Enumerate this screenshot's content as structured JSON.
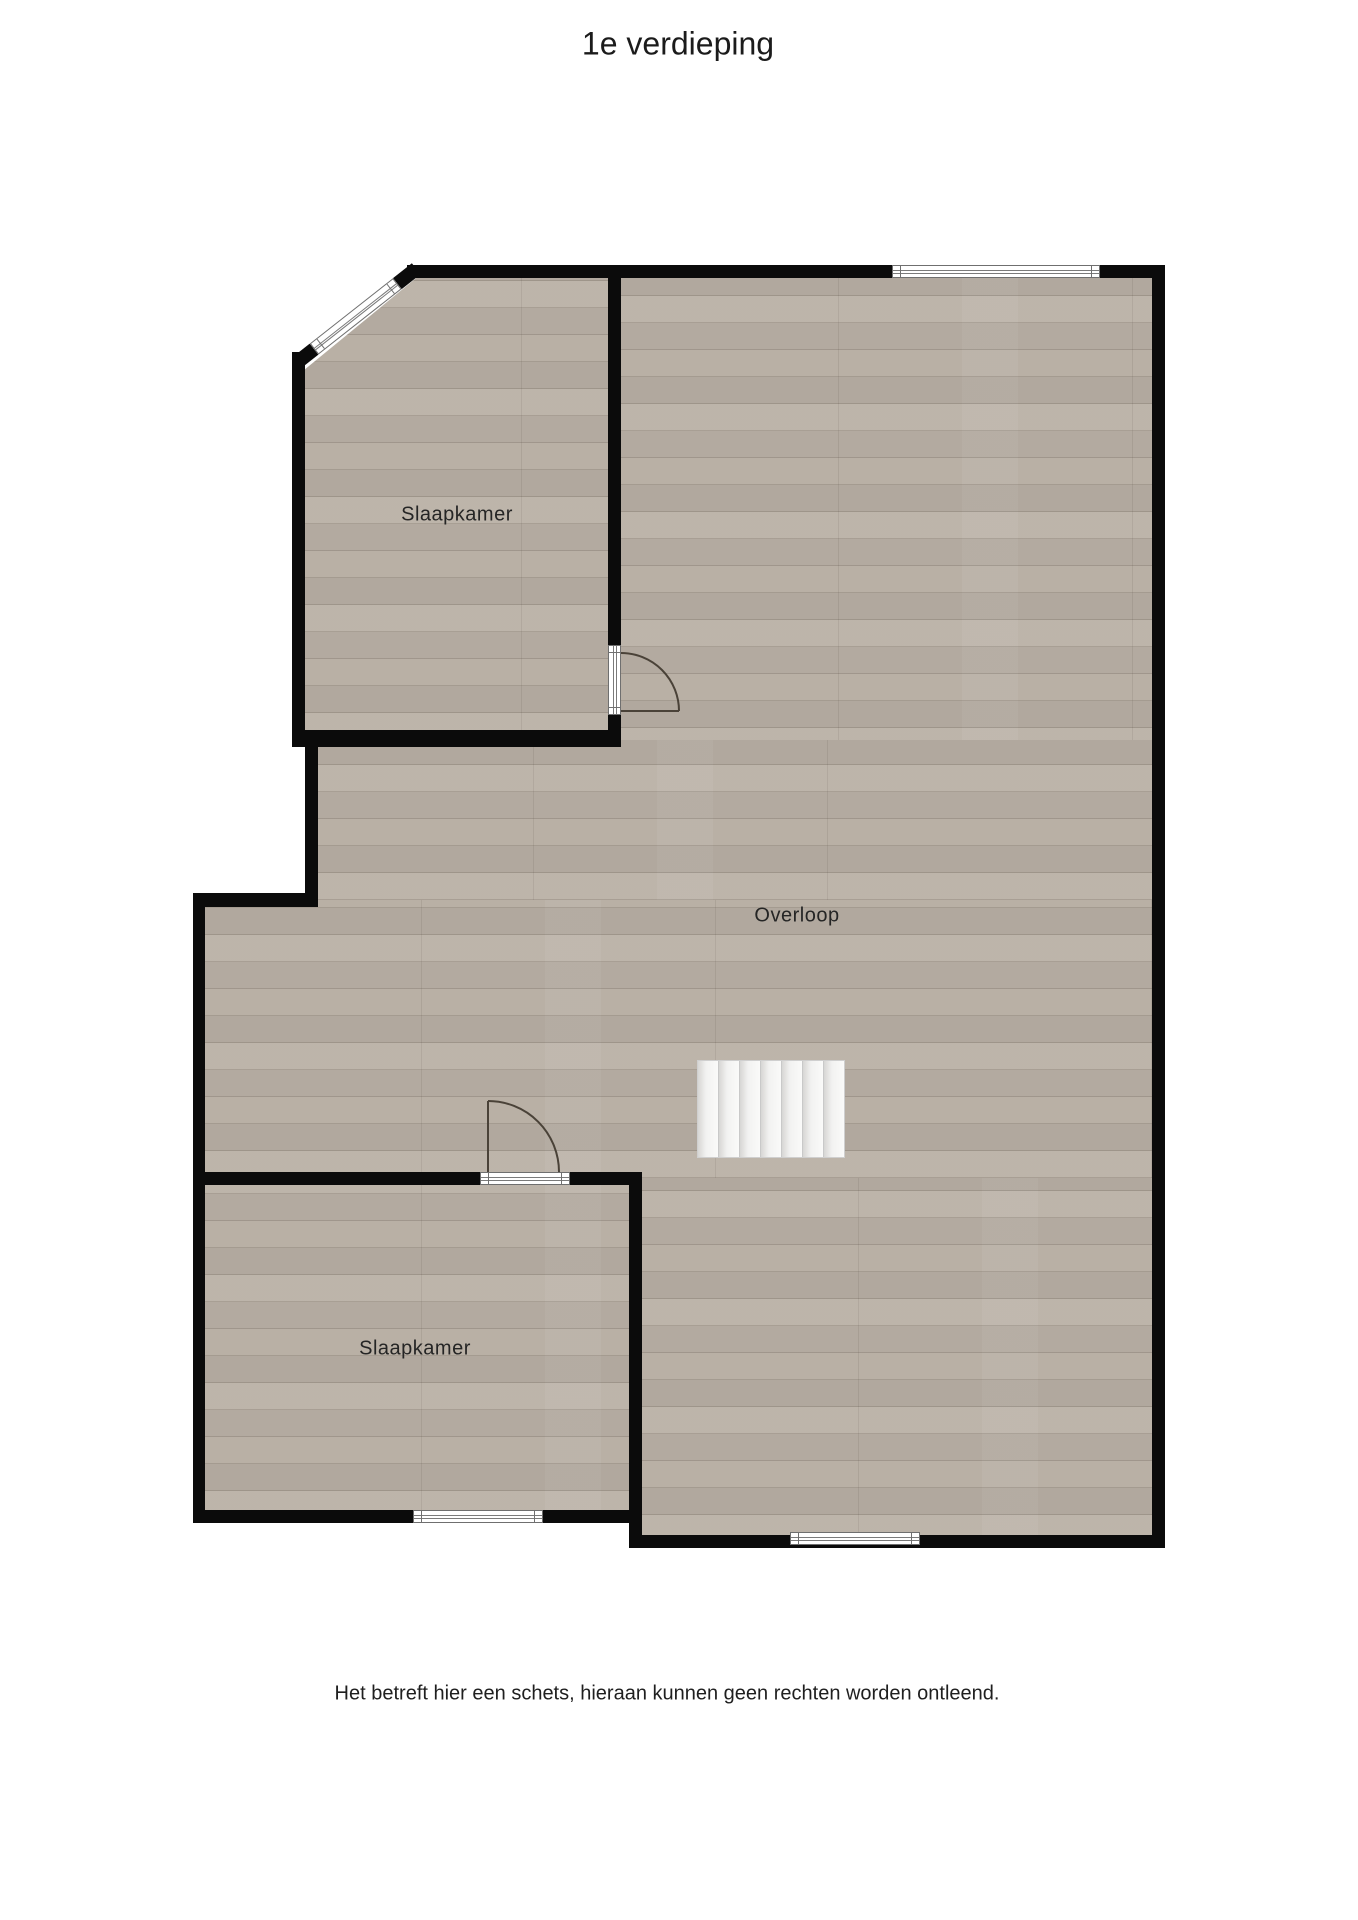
{
  "title": "1e verdieping",
  "rooms": [
    {
      "label": "Slaapkamer"
    },
    {
      "label": "Overloop"
    },
    {
      "label": "Slaapkamer"
    }
  ],
  "disclaimer": "Het betreft hier een schets, hieraan kunnen geen rechten worden ontleend.",
  "colors": {
    "wall": "#0b0b0b",
    "floor": "#b9b0a5",
    "door_swing": "#4a4238",
    "stair_fill": "#f4f4f3",
    "text": "#252525"
  }
}
